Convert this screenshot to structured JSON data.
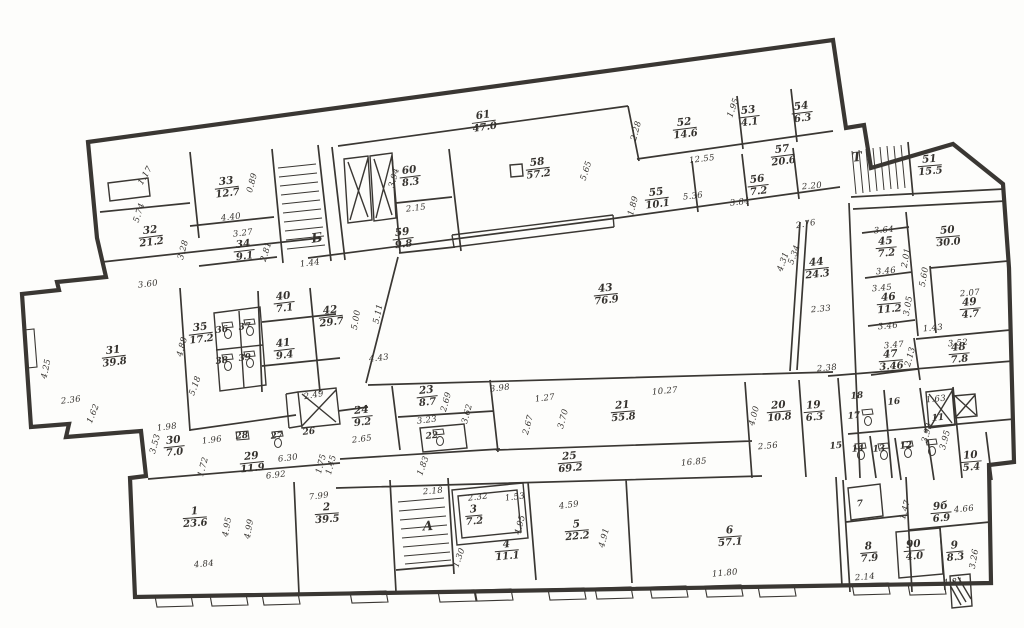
{
  "plan": {
    "paper_color": "#fdfdfb",
    "ink_color": "#35322e",
    "drawing_type": "floor-plan",
    "stair_letters": [
      {
        "t": "А",
        "x": 428,
        "y": 527,
        "r": -3
      },
      {
        "t": "Б",
        "x": 317,
        "y": 239,
        "r": -8
      },
      {
        "t": "Т",
        "x": 857,
        "y": 158,
        "r": -5
      }
    ],
    "rooms": [
      {
        "n": "1",
        "a": "23.6",
        "x": 195,
        "y": 518,
        "r": -4
      },
      {
        "n": "2",
        "a": "39.5",
        "x": 327,
        "y": 514,
        "r": -4
      },
      {
        "n": "3",
        "a": "7.2",
        "x": 474,
        "y": 516,
        "r": -5
      },
      {
        "n": "4",
        "a": "11.1",
        "x": 507,
        "y": 551,
        "r": -5
      },
      {
        "n": "5",
        "a": "22.2",
        "x": 577,
        "y": 531,
        "r": -5
      },
      {
        "n": "6",
        "a": "57.1",
        "x": 730,
        "y": 537,
        "r": -4
      },
      {
        "n": "7",
        "x": 860,
        "y": 505,
        "r": -5
      },
      {
        "n": "8",
        "a": "7.9",
        "x": 869,
        "y": 553,
        "r": -5
      },
      {
        "n": "9б",
        "a": "6.9",
        "x": 941,
        "y": 513,
        "r": -5
      },
      {
        "n": "90",
        "a": "4.0",
        "x": 914,
        "y": 551,
        "r": -5
      },
      {
        "n": "9",
        "a": "8.3",
        "x": 955,
        "y": 552,
        "r": -5
      },
      {
        "n": "10",
        "a": "5.4",
        "x": 971,
        "y": 462,
        "r": -5
      },
      {
        "n": "11",
        "x": 938,
        "y": 419,
        "r": -5
      },
      {
        "n": "12",
        "x": 906,
        "y": 447,
        "r": -5
      },
      {
        "n": "13",
        "x": 879,
        "y": 450,
        "r": -5
      },
      {
        "n": "14",
        "x": 858,
        "y": 450,
        "r": -5
      },
      {
        "n": "15",
        "x": 836,
        "y": 447,
        "r": -5
      },
      {
        "n": "16",
        "x": 894,
        "y": 403,
        "r": -5
      },
      {
        "n": "17",
        "x": 854,
        "y": 417,
        "r": -5
      },
      {
        "n": "18",
        "x": 857,
        "y": 397,
        "r": -5
      },
      {
        "n": "19",
        "a": "6.3",
        "x": 814,
        "y": 412,
        "r": -5
      },
      {
        "n": "20",
        "a": "10.8",
        "x": 779,
        "y": 412,
        "r": -5
      },
      {
        "n": "21",
        "a": "55.8",
        "x": 623,
        "y": 412,
        "r": -5
      },
      {
        "n": "22",
        "x": 432,
        "y": 437,
        "r": -5
      },
      {
        "n": "23",
        "a": "8.7",
        "x": 427,
        "y": 397,
        "r": -6
      },
      {
        "n": "24",
        "a": "9.2",
        "x": 362,
        "y": 417,
        "r": -6
      },
      {
        "n": "25",
        "a": "69.2",
        "x": 570,
        "y": 463,
        "r": -5
      },
      {
        "n": "26",
        "x": 309,
        "y": 433,
        "r": -6
      },
      {
        "n": "27",
        "x": 277,
        "y": 437,
        "r": -6
      },
      {
        "n": "28",
        "x": 242,
        "y": 437,
        "r": -6
      },
      {
        "n": "29",
        "a": "11.9",
        "x": 252,
        "y": 463,
        "r": -6
      },
      {
        "n": "30",
        "a": "7.0",
        "x": 174,
        "y": 447,
        "r": -6
      },
      {
        "n": "31",
        "a": "39.8",
        "x": 114,
        "y": 357,
        "r": -7
      },
      {
        "n": "32",
        "a": "21.2",
        "x": 151,
        "y": 237,
        "r": -7
      },
      {
        "n": "33",
        "a": "12.7",
        "x": 227,
        "y": 188,
        "r": -7
      },
      {
        "n": "34",
        "a": "9.1",
        "x": 244,
        "y": 251,
        "r": -7
      },
      {
        "n": "35",
        "a": "17.2",
        "x": 201,
        "y": 334,
        "r": -7
      },
      {
        "n": "36",
        "x": 222,
        "y": 331,
        "r": -7
      },
      {
        "n": "37",
        "x": 245,
        "y": 328,
        "r": -7
      },
      {
        "n": "38",
        "x": 222,
        "y": 362,
        "r": -7
      },
      {
        "n": "39",
        "x": 245,
        "y": 359,
        "r": -7
      },
      {
        "n": "40",
        "a": "7.1",
        "x": 284,
        "y": 303,
        "r": -7
      },
      {
        "n": "41",
        "a": "9.4",
        "x": 284,
        "y": 350,
        "r": -7
      },
      {
        "n": "42",
        "a": "29.7",
        "x": 331,
        "y": 317,
        "r": -7
      },
      {
        "n": "43",
        "a": "76.9",
        "x": 606,
        "y": 295,
        "r": -6
      },
      {
        "n": "44",
        "a": "24.3",
        "x": 817,
        "y": 269,
        "r": -6
      },
      {
        "n": "45",
        "a": "7.2",
        "x": 886,
        "y": 248,
        "r": -5
      },
      {
        "n": "46",
        "a": "11.2",
        "x": 889,
        "y": 304,
        "r": -5
      },
      {
        "n": "47",
        "a": "3.46",
        "x": 891,
        "y": 361,
        "r": -5
      },
      {
        "n": "48",
        "a": "7.8",
        "x": 959,
        "y": 354,
        "r": -5
      },
      {
        "n": "49",
        "a": "4.7",
        "x": 970,
        "y": 309,
        "r": -5
      },
      {
        "n": "50",
        "a": "30.0",
        "x": 948,
        "y": 237,
        "r": -5
      },
      {
        "n": "51",
        "a": "15.5",
        "x": 930,
        "y": 166,
        "r": -5
      },
      {
        "n": "52",
        "a": "14.6",
        "x": 685,
        "y": 129,
        "r": -7
      },
      {
        "n": "53",
        "a": "4.1",
        "x": 749,
        "y": 117,
        "r": -7
      },
      {
        "n": "54",
        "a": "6.3",
        "x": 802,
        "y": 113,
        "r": -7
      },
      {
        "n": "55",
        "a": "10.1",
        "x": 657,
        "y": 199,
        "r": -7
      },
      {
        "n": "56",
        "a": "7.2",
        "x": 758,
        "y": 186,
        "r": -7
      },
      {
        "n": "57",
        "a": "20.6",
        "x": 783,
        "y": 156,
        "r": -7
      },
      {
        "n": "58",
        "a": "57.2",
        "x": 538,
        "y": 169,
        "r": -7
      },
      {
        "n": "59",
        "a": "9.8",
        "x": 403,
        "y": 239,
        "r": -7
      },
      {
        "n": "60",
        "a": "8.3",
        "x": 410,
        "y": 177,
        "r": -7
      },
      {
        "n": "61",
        "a": "47.0",
        "x": 484,
        "y": 122,
        "r": -8
      }
    ],
    "dims": [
      {
        "t": "1.17",
        "x": 146,
        "y": 176,
        "r": -60
      },
      {
        "t": "5.74",
        "x": 140,
        "y": 213,
        "r": -72
      },
      {
        "t": "0.89",
        "x": 253,
        "y": 183,
        "r": -75
      },
      {
        "t": "4.40",
        "x": 231,
        "y": 218,
        "r": -7
      },
      {
        "t": "3.27",
        "x": 243,
        "y": 234,
        "r": -7
      },
      {
        "t": "2.81",
        "x": 267,
        "y": 252,
        "r": -73
      },
      {
        "t": "3.28",
        "x": 184,
        "y": 250,
        "r": -75
      },
      {
        "t": "1.44",
        "x": 310,
        "y": 264,
        "r": -7
      },
      {
        "t": "3.60",
        "x": 148,
        "y": 285,
        "r": -7
      },
      {
        "t": "2.15",
        "x": 416,
        "y": 209,
        "r": -7
      },
      {
        "t": "3.94",
        "x": 395,
        "y": 178,
        "r": -75
      },
      {
        "t": "4.88",
        "x": 183,
        "y": 347,
        "r": -75
      },
      {
        "t": "5.18",
        "x": 196,
        "y": 386,
        "r": -70
      },
      {
        "t": "4.43",
        "x": 379,
        "y": 359,
        "r": -7
      },
      {
        "t": "5.00",
        "x": 357,
        "y": 320,
        "r": -80
      },
      {
        "t": "5.11",
        "x": 379,
        "y": 314,
        "r": -78
      },
      {
        "t": "4.25",
        "x": 47,
        "y": 369,
        "r": -78
      },
      {
        "t": "2.36",
        "x": 71,
        "y": 401,
        "r": -7
      },
      {
        "t": "1.62",
        "x": 94,
        "y": 414,
        "r": -68
      },
      {
        "t": "1.98",
        "x": 167,
        "y": 428,
        "r": -7
      },
      {
        "t": "3.53",
        "x": 156,
        "y": 444,
        "r": -75
      },
      {
        "t": "1.96",
        "x": 212,
        "y": 441,
        "r": -7
      },
      {
        "t": "1.72",
        "x": 204,
        "y": 467,
        "r": -75
      },
      {
        "t": "6.30",
        "x": 288,
        "y": 459,
        "r": -7
      },
      {
        "t": "6.92",
        "x": 276,
        "y": 476,
        "r": -7
      },
      {
        "t": "1.45",
        "x": 332,
        "y": 465,
        "r": -75
      },
      {
        "t": "2.65",
        "x": 362,
        "y": 440,
        "r": -7
      },
      {
        "t": "3.23",
        "x": 427,
        "y": 421,
        "r": -7
      },
      {
        "t": "2.69",
        "x": 447,
        "y": 402,
        "r": -75
      },
      {
        "t": "3.62",
        "x": 468,
        "y": 414,
        "r": -75
      },
      {
        "t": "2.49",
        "x": 314,
        "y": 396,
        "r": -10
      },
      {
        "t": "1.75",
        "x": 322,
        "y": 464,
        "r": -75
      },
      {
        "t": "1.83",
        "x": 424,
        "y": 466,
        "r": -70
      },
      {
        "t": "3.98",
        "x": 500,
        "y": 389,
        "r": -7
      },
      {
        "t": "1.27",
        "x": 545,
        "y": 399,
        "r": -7
      },
      {
        "t": "2.67",
        "x": 529,
        "y": 425,
        "r": -75
      },
      {
        "t": "3.70",
        "x": 564,
        "y": 419,
        "r": -75
      },
      {
        "t": "10.27",
        "x": 665,
        "y": 392,
        "r": -5
      },
      {
        "t": "16.85",
        "x": 694,
        "y": 463,
        "r": -5
      },
      {
        "t": "2.56",
        "x": 768,
        "y": 447,
        "r": -5
      },
      {
        "t": "4.00",
        "x": 755,
        "y": 416,
        "r": -75
      },
      {
        "t": "1.63",
        "x": 936,
        "y": 400,
        "r": -5
      },
      {
        "t": "3.93",
        "x": 928,
        "y": 433,
        "r": -75
      },
      {
        "t": "3.95",
        "x": 946,
        "y": 440,
        "r": -75
      },
      {
        "t": "2.20",
        "x": 812,
        "y": 187,
        "r": -5
      },
      {
        "t": "2.76",
        "x": 806,
        "y": 225,
        "r": -10
      },
      {
        "t": "12.55",
        "x": 702,
        "y": 160,
        "r": -7
      },
      {
        "t": "1.95",
        "x": 734,
        "y": 108,
        "r": -70
      },
      {
        "t": "2.28",
        "x": 637,
        "y": 131,
        "r": -75
      },
      {
        "t": "1.89",
        "x": 634,
        "y": 206,
        "r": -75
      },
      {
        "t": "5.36",
        "x": 693,
        "y": 197,
        "r": -7
      },
      {
        "t": "3.84",
        "x": 740,
        "y": 203,
        "r": -7
      },
      {
        "t": "5.65",
        "x": 587,
        "y": 171,
        "r": -72
      },
      {
        "t": "4.31",
        "x": 784,
        "y": 262,
        "r": -70
      },
      {
        "t": "5.34",
        "x": 795,
        "y": 255,
        "r": -70
      },
      {
        "t": "2.33",
        "x": 821,
        "y": 310,
        "r": -5
      },
      {
        "t": "2.38",
        "x": 827,
        "y": 369,
        "r": -5
      },
      {
        "t": "3.64",
        "x": 884,
        "y": 231,
        "r": -5
      },
      {
        "t": "3.46",
        "x": 886,
        "y": 272,
        "r": -5
      },
      {
        "t": "3.45",
        "x": 882,
        "y": 289,
        "r": -5
      },
      {
        "t": "3.46",
        "x": 888,
        "y": 327,
        "r": -5
      },
      {
        "t": "3.05",
        "x": 909,
        "y": 306,
        "r": -80
      },
      {
        "t": "2.01",
        "x": 907,
        "y": 258,
        "r": -80
      },
      {
        "t": "5.60",
        "x": 925,
        "y": 277,
        "r": -80
      },
      {
        "t": "2.07",
        "x": 970,
        "y": 294,
        "r": -5
      },
      {
        "t": "1.43",
        "x": 933,
        "y": 329,
        "r": -5
      },
      {
        "t": "3.47",
        "x": 894,
        "y": 346,
        "r": -5
      },
      {
        "t": "2.13",
        "x": 911,
        "y": 357,
        "r": -75
      },
      {
        "t": "3.52",
        "x": 958,
        "y": 344,
        "r": -5
      },
      {
        "t": "4.84",
        "x": 204,
        "y": 565,
        "r": -5
      },
      {
        "t": "4.95",
        "x": 228,
        "y": 527,
        "r": -80
      },
      {
        "t": "4.99",
        "x": 250,
        "y": 529,
        "r": -80
      },
      {
        "t": "7.99",
        "x": 319,
        "y": 497,
        "r": -7
      },
      {
        "t": "2.18",
        "x": 433,
        "y": 492,
        "r": -5
      },
      {
        "t": "2.32",
        "x": 478,
        "y": 498,
        "r": -7
      },
      {
        "t": "1.53",
        "x": 515,
        "y": 498,
        "r": -7
      },
      {
        "t": "4.95",
        "x": 521,
        "y": 525,
        "r": -75
      },
      {
        "t": "1.30",
        "x": 460,
        "y": 558,
        "r": -70
      },
      {
        "t": "4.59",
        "x": 569,
        "y": 506,
        "r": -7
      },
      {
        "t": "4.91",
        "x": 605,
        "y": 538,
        "r": -75
      },
      {
        "t": "11.80",
        "x": 725,
        "y": 574,
        "r": -5
      },
      {
        "t": "2.14",
        "x": 865,
        "y": 578,
        "r": -5
      },
      {
        "t": "1.47",
        "x": 906,
        "y": 510,
        "r": -75
      },
      {
        "t": "4.66",
        "x": 964,
        "y": 510,
        "r": -5
      },
      {
        "t": "3.26",
        "x": 975,
        "y": 559,
        "r": -80
      },
      {
        "t": "4.81",
        "x": 953,
        "y": 583,
        "r": -5
      }
    ]
  }
}
